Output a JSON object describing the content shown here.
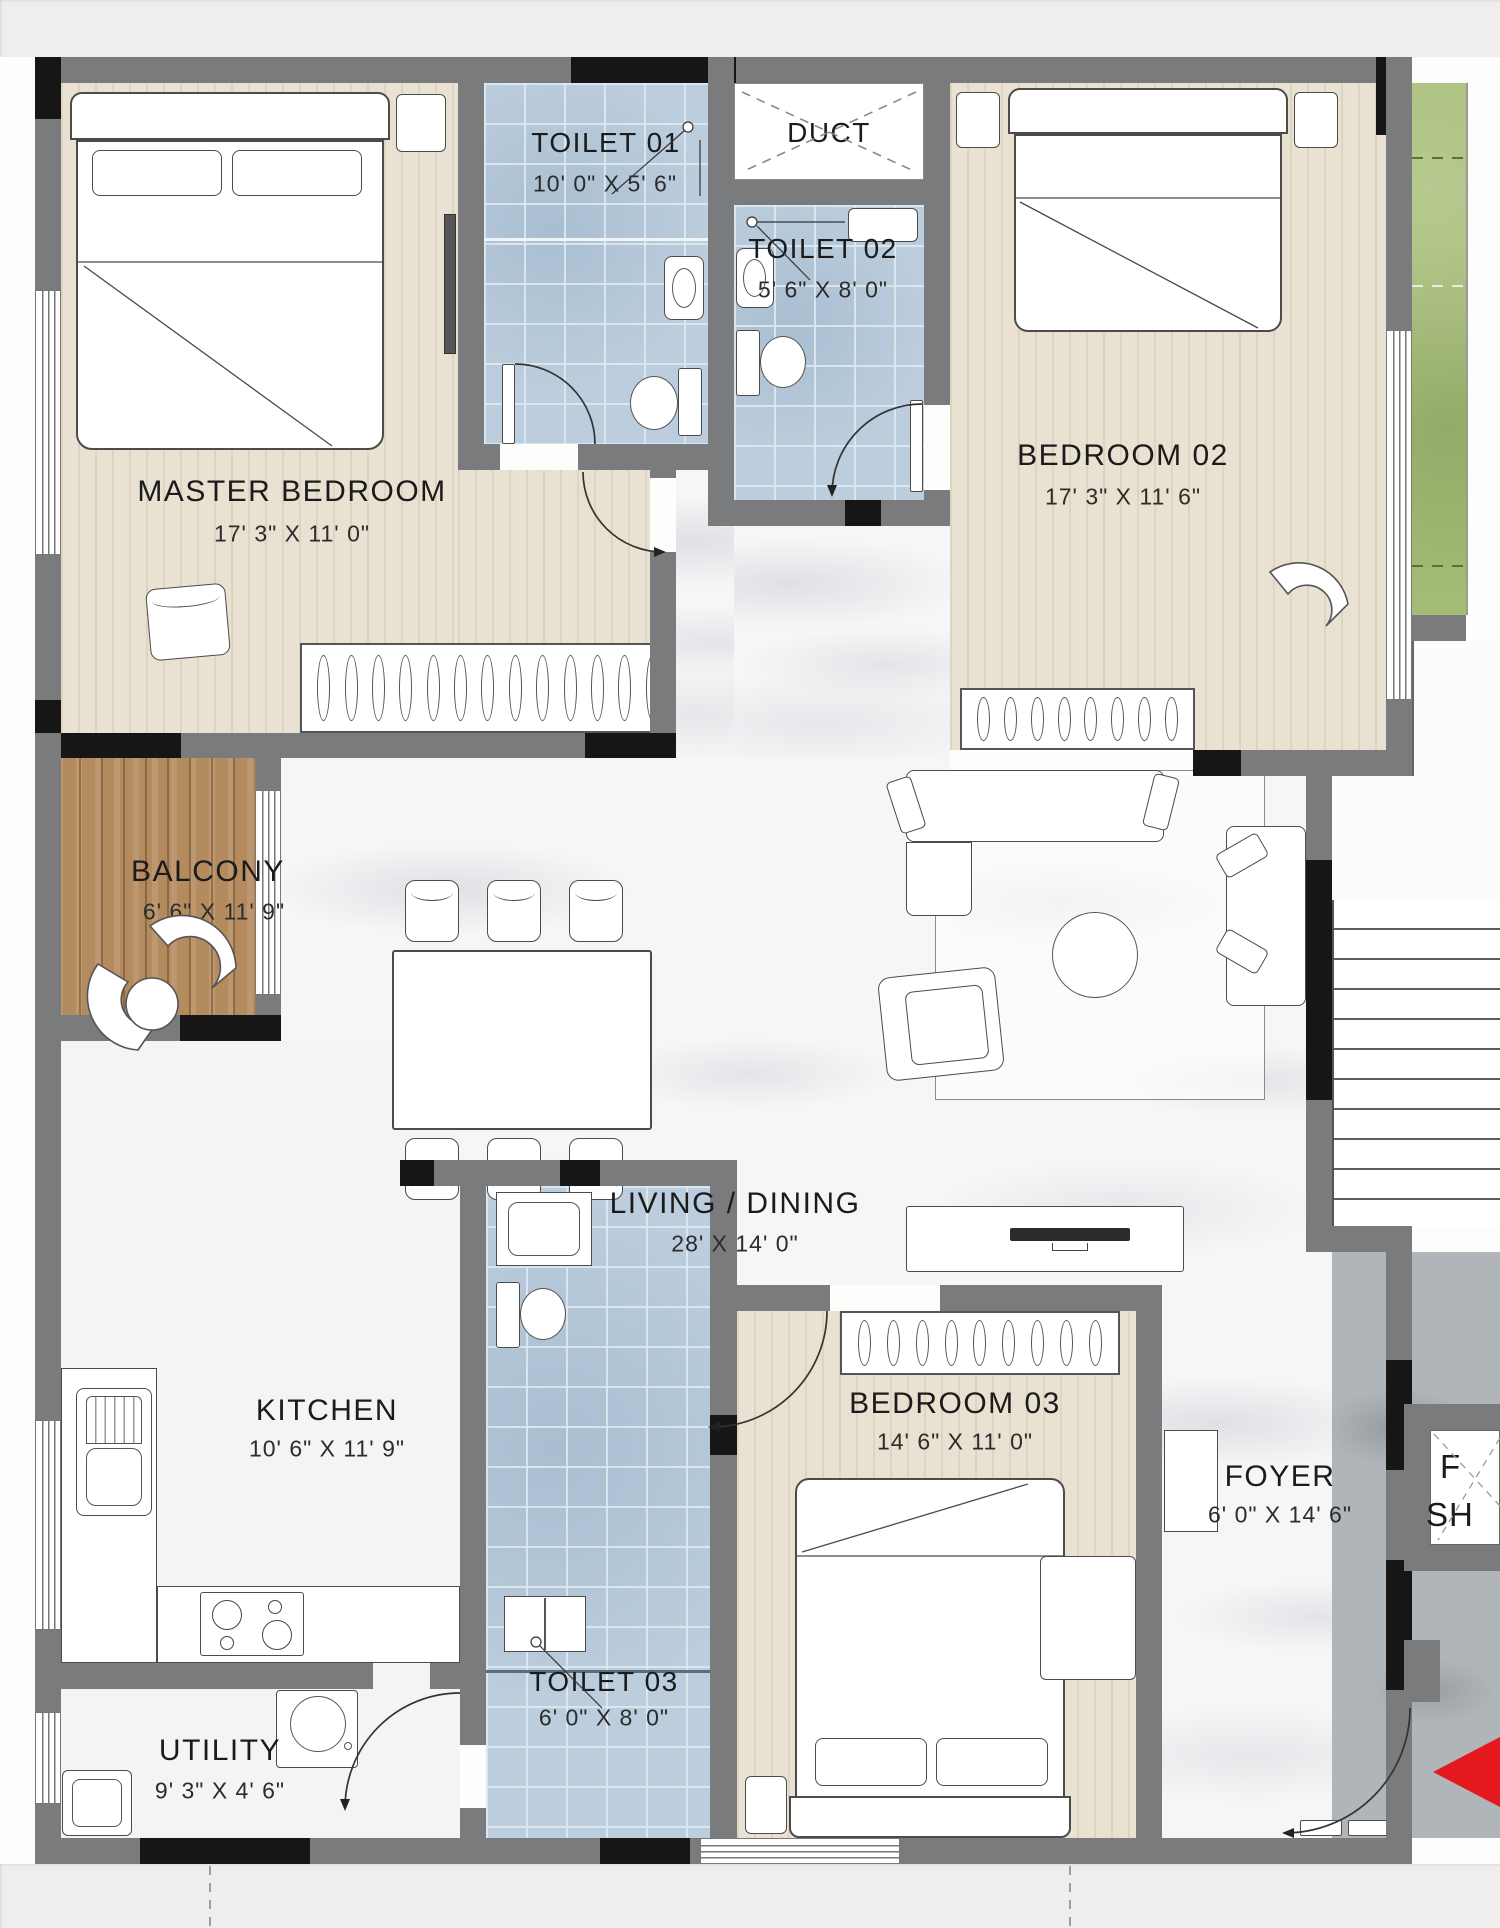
{
  "plan_title": "3 BHK Apartment Floor Plan",
  "rooms": {
    "master_bedroom": {
      "name": "MASTER BEDROOM",
      "dims": "17' 3\" X 11' 0\""
    },
    "toilet_01": {
      "name": "TOILET 01",
      "dims": "10' 0\" X 5' 6\""
    },
    "duct": {
      "name": "DUCT",
      "dims": ""
    },
    "toilet_02": {
      "name": "TOILET 02",
      "dims": "5' 6\" X 8' 0\""
    },
    "bedroom_02": {
      "name": "BEDROOM 02",
      "dims": "17' 3\" X 11' 6\""
    },
    "balcony": {
      "name": "BALCONY",
      "dims": "6' 6\" X 11' 9\""
    },
    "living_dining": {
      "name": "LIVING / DINING",
      "dims": "28' X 14' 0\""
    },
    "kitchen": {
      "name": "KITCHEN",
      "dims": "10' 6\" X 11' 9\""
    },
    "bedroom_03": {
      "name": "BEDROOM 03",
      "dims": "14' 6\" X 11' 0\""
    },
    "foyer": {
      "name": "FOYER",
      "dims": "6' 0\" X 14' 6\""
    },
    "toilet_03": {
      "name": "TOILET 03",
      "dims": "6' 0\" X 8' 0\""
    },
    "utility": {
      "name": "UTILITY",
      "dims": "9' 3\" X 4' 6\""
    },
    "fire_shaft": {
      "line1": "F",
      "line2": "SH"
    }
  },
  "colors": {
    "wall_gray": "#7a7b7d",
    "wall_black": "#161616",
    "floor_beige": "#e9e1d2",
    "tile_blue": "#bccddd",
    "balcony_wood": "#b48b5f",
    "marble_white": "#f6f6f8",
    "lawn_green": "#a6bd77",
    "corridor_gray": "#b0b5b9",
    "entry_arrow_red": "#e5191d"
  },
  "icons": {
    "entry_arrow": "entry-direction-arrow"
  }
}
